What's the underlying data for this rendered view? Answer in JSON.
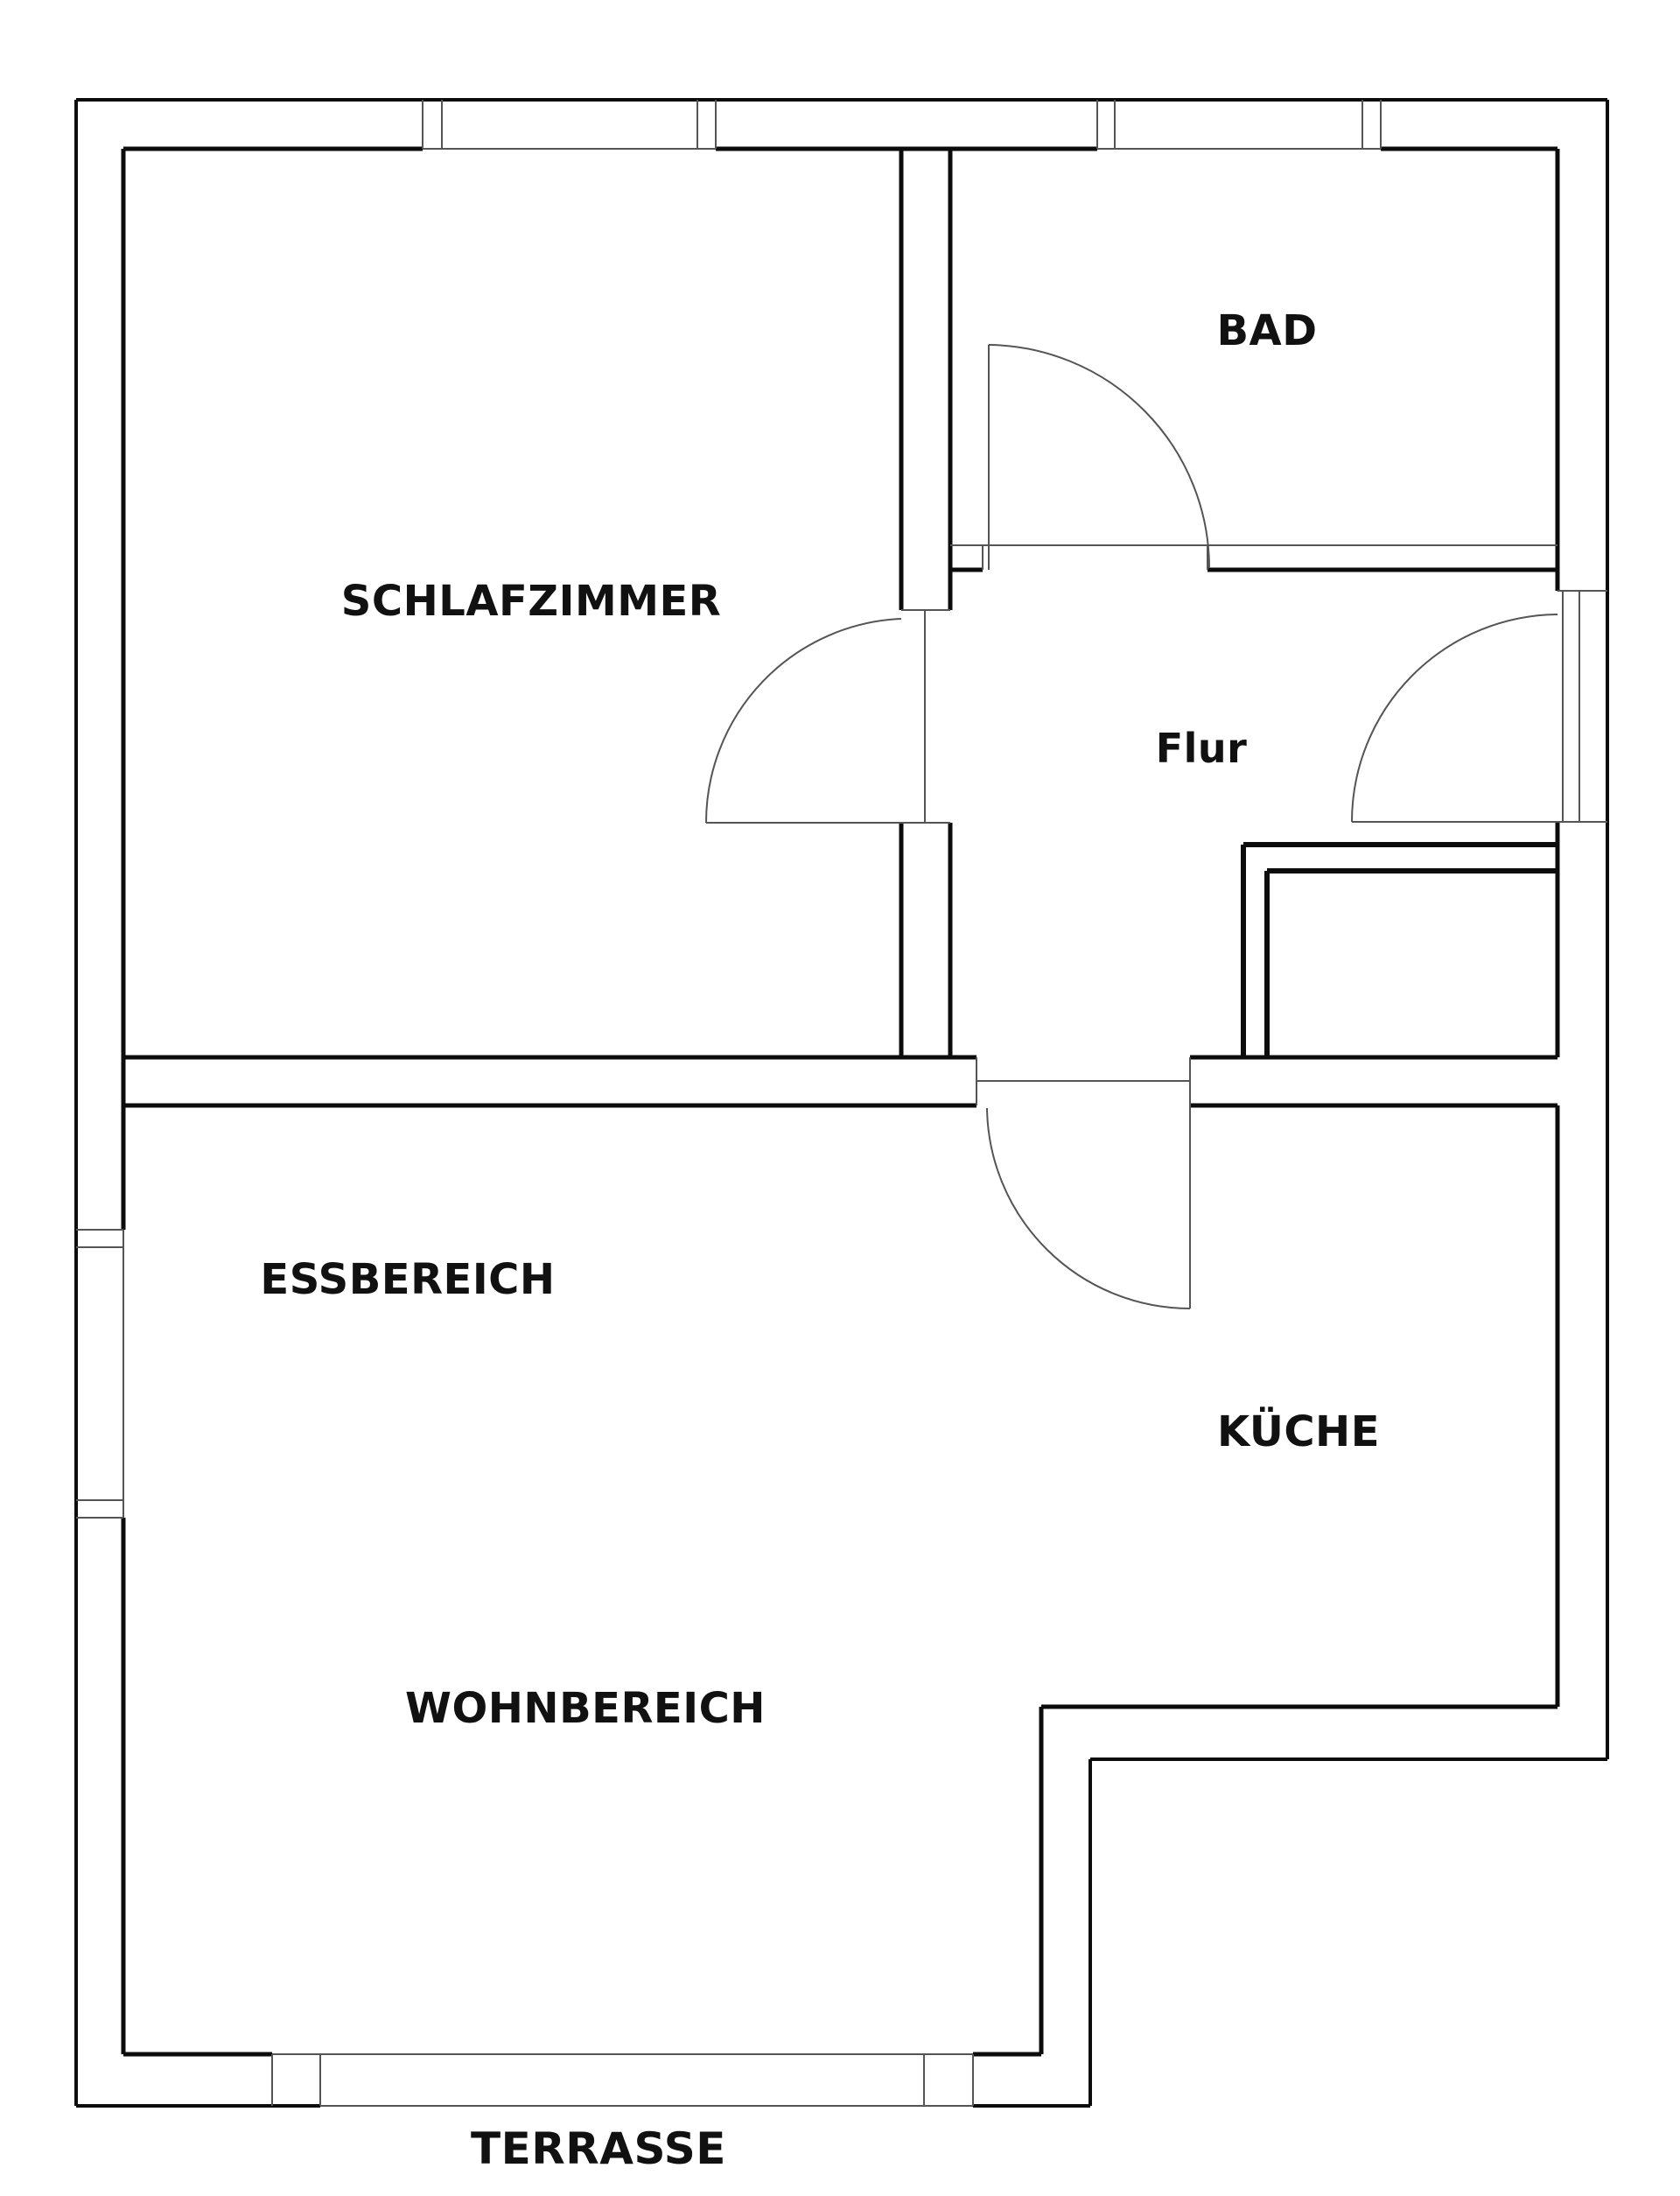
{
  "rooms": {
    "schlafzimmer": "SCHLAFZIMMER",
    "bad": "BAD",
    "flur": "Flur",
    "essbereich": "ESSBEREICH",
    "kueche": "KÜCHE",
    "wohnbereich": "WOHNBEREICH",
    "terrasse": "TERRASSE"
  },
  "colors": {
    "wall": "#0c0c0c",
    "thin_line": "#555555",
    "background": "#ffffff",
    "label_text": "#111111"
  }
}
